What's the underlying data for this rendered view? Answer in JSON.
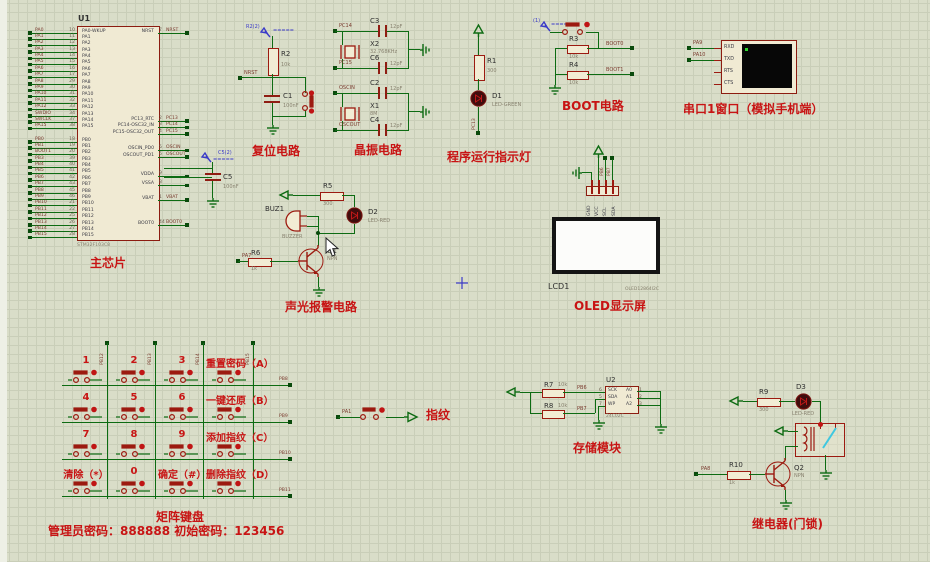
{
  "colors": {
    "wire_green": "#0d6b12",
    "component_red": "#9c1a10",
    "label_red": "#c81414",
    "annot_blue": "#3a3ac8",
    "grid_bg": "#d9ddc8",
    "beige": "#f2ecd4"
  },
  "chip": {
    "ref": "U1",
    "part": "STM32F103C8",
    "label": "主芯片",
    "left_a": [
      {
        "net": "PA0",
        "num": "10",
        "name": "PA0-WKUP"
      },
      {
        "net": "PA1",
        "num": "11",
        "name": "PA1"
      },
      {
        "net": "PA2",
        "num": "12",
        "name": "PA2"
      },
      {
        "net": "PA3",
        "num": "13",
        "name": "PA3"
      },
      {
        "net": "PA4",
        "num": "14",
        "name": "PA4"
      },
      {
        "net": "PA5",
        "num": "15",
        "name": "PA5"
      },
      {
        "net": "PA6",
        "num": "16",
        "name": "PA6"
      },
      {
        "net": "PA7",
        "num": "17",
        "name": "PA7"
      },
      {
        "net": "PA8",
        "num": "29",
        "name": "PA8"
      },
      {
        "net": "PA9",
        "num": "30",
        "name": "PA9"
      },
      {
        "net": "PA10",
        "num": "31",
        "name": "PA10"
      },
      {
        "net": "PA11",
        "num": "32",
        "name": "PA11"
      },
      {
        "net": "PA12",
        "num": "33",
        "name": "PA12"
      },
      {
        "net": "SWDIO",
        "num": "34",
        "name": "PA13"
      },
      {
        "net": "SWCLK",
        "num": "37",
        "name": "PA14"
      },
      {
        "net": "PA15",
        "num": "38",
        "name": "PA15"
      }
    ],
    "left_b": [
      {
        "net": "PB0",
        "num": "18",
        "name": "PB0"
      },
      {
        "net": "PB1",
        "num": "19",
        "name": "PB1"
      },
      {
        "net": "BOOT1",
        "num": "20",
        "name": "PB2"
      },
      {
        "net": "PB3",
        "num": "39",
        "name": "PB3"
      },
      {
        "net": "PB4",
        "num": "40",
        "name": "PB4"
      },
      {
        "net": "PB5",
        "num": "41",
        "name": "PB5"
      },
      {
        "net": "PB6",
        "num": "42",
        "name": "PB6"
      },
      {
        "net": "PB7",
        "num": "43",
        "name": "PB7"
      },
      {
        "net": "PB8",
        "num": "45",
        "name": "PB8"
      },
      {
        "net": "PB9",
        "num": "46",
        "name": "PB9"
      },
      {
        "net": "PB10",
        "num": "21",
        "name": "PB10"
      },
      {
        "net": "PB11",
        "num": "22",
        "name": "PB11"
      },
      {
        "net": "PB12",
        "num": "25",
        "name": "PB12"
      },
      {
        "net": "PB13",
        "num": "26",
        "name": "PB13"
      },
      {
        "net": "PB14",
        "num": "27",
        "name": "PB14"
      },
      {
        "net": "PB15",
        "num": "28",
        "name": "PB15"
      }
    ],
    "right": [
      {
        "name": "NRST",
        "num": "7",
        "net": "NRST"
      },
      {
        "name": "PC13_RTC",
        "num": "2",
        "net": "PC13"
      },
      {
        "name": "PC14-OSC32_IN",
        "num": "3",
        "net": "PC14"
      },
      {
        "name": "PC15-OSC32_OUT",
        "num": "4",
        "net": "PC15"
      },
      {
        "name": "OSCIN_PD0",
        "num": "5",
        "net": "OSCIN"
      },
      {
        "name": "OSCOUT_PD1",
        "num": "6",
        "net": "OSCOUT"
      },
      {
        "name": "VDDA",
        "num": "9",
        "net": ""
      },
      {
        "name": "VSSA",
        "num": "8",
        "net": ""
      },
      {
        "name": "VBAT",
        "num": "1",
        "net": "VBAT"
      },
      {
        "name": "BOOT0",
        "num": "44",
        "net": "BOOT0"
      }
    ]
  },
  "reset": {
    "label": "复位电路",
    "annot": "R2(2)",
    "marks": "=====",
    "r_ref": "R2",
    "r_val": "10k",
    "net": "NRST",
    "c_ref": "C1",
    "c_val": "100nF"
  },
  "crystal": {
    "label": "晶振电路",
    "groups": [
      {
        "top_net": "PC14",
        "top_cap": "C3",
        "cap_val": "12pF",
        "xtal": "X2",
        "freq": "32.768KHz",
        "bot_net": "PC15",
        "bot_cap": "C6"
      },
      {
        "top_net": "OSCIN",
        "top_cap": "C2",
        "cap_val": "12pF",
        "xtal": "X1",
        "freq": "8M",
        "bot_net": "OSCOUT",
        "bot_cap": "C4"
      }
    ]
  },
  "indicator": {
    "label": "程序运行指示灯",
    "r_ref": "R1",
    "r_val": "300",
    "d_ref": "D1",
    "d_val": "LED-GREEN",
    "net": "PC13"
  },
  "boot": {
    "label": "BOOT电路",
    "annot": "(1)",
    "marks": "=====",
    "r3_ref": "R3",
    "r3_val": "10k",
    "net0": "BOOT0",
    "r4_ref": "R4",
    "r4_val": "10k",
    "net1": "BOOT1"
  },
  "serial": {
    "label": "串口1窗口（模拟手机端）",
    "pins": [
      "RXD",
      "TXD",
      "RTS",
      "CTS"
    ],
    "net1": "PA9",
    "net2": "PA10"
  },
  "c5": {
    "annot": "C5(2)",
    "marks": "=====",
    "ref": "C5",
    "val": "100nF"
  },
  "alarm": {
    "label": "声光报警电路",
    "buz_ref": "BUZ1",
    "buz_val": "BUZZER",
    "r5_ref": "R5",
    "r5_val": "300",
    "d2_ref": "D2",
    "d2_val": "LED-RED",
    "q_ref": "Q1",
    "q_val": "NPN",
    "r6_ref": "R6",
    "r6_val": "1k",
    "net": "PA7"
  },
  "oled": {
    "label": "OLED显示屏",
    "ref": "LCD1",
    "part": "OLED12864I2C",
    "pins": [
      "GND",
      "VCC",
      "SCL",
      "SDA"
    ],
    "net1": "PB6",
    "net2": "PB7"
  },
  "keypad": {
    "label": "矩阵键盘",
    "admin": "管理员密码：888888  初始密码：123456",
    "col_nets": [
      "PB12",
      "PB13",
      "PB14",
      "PB15"
    ],
    "row_nets": [
      "PB8",
      "PB9",
      "PB10",
      "PB11"
    ],
    "keys": [
      "1",
      "2",
      "3",
      "重置密码（A）",
      "4",
      "5",
      "6",
      "一键还原（B）",
      "7",
      "8",
      "9",
      "添加指纹（C）",
      "清除（*）",
      "0",
      "确定（#）",
      "删除指纹（D）"
    ]
  },
  "finger": {
    "label": "指纹",
    "net": "PA1"
  },
  "storage": {
    "label": "存储模块",
    "ref": "U2",
    "part": "24C02C",
    "r7_ref": "R7",
    "r7_val": "10k",
    "r8_ref": "R8",
    "r8_val": "10k",
    "net1": "PB6",
    "net2": "PB7",
    "lpins": [
      {
        "nm": "SCK",
        "no": "6"
      },
      {
        "nm": "SDA",
        "no": "5"
      },
      {
        "nm": "WP",
        "no": "7"
      }
    ],
    "rpins": [
      {
        "nm": "A0",
        "no": "1"
      },
      {
        "nm": "A1",
        "no": "2"
      },
      {
        "nm": "A2",
        "no": "3"
      }
    ]
  },
  "relay": {
    "label": "继电器(门锁)",
    "r9_ref": "R9",
    "r9_val": "300",
    "d3_ref": "D3",
    "d3_val": "LED-RED",
    "q_ref": "Q2",
    "q_val": "NPN",
    "r10_ref": "R10",
    "r10_val": "1k",
    "net": "PA8"
  }
}
